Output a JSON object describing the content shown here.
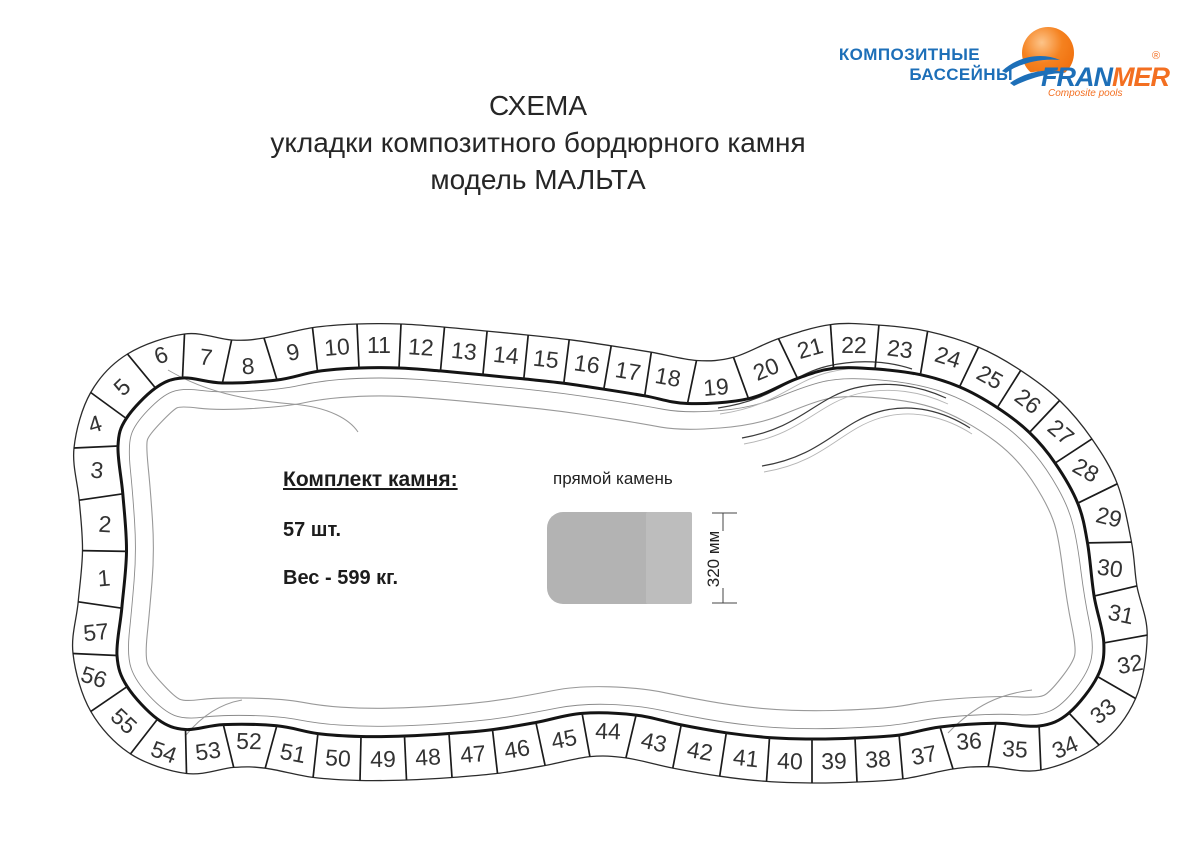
{
  "page": {
    "background": "#ffffff"
  },
  "brand": {
    "tagline_line1": "КОМПОЗИТНЫЕ",
    "tagline_line2": "БАССЕЙНЫ",
    "logo_fran": "FRAN",
    "logo_mer": "MER",
    "logo_subtitle": "Composite pools",
    "registered_mark": "®",
    "blue": "#1d6fb8",
    "orange": "#f36f21"
  },
  "title": {
    "line1": "СХЕМА",
    "line2": "укладки композитного бордюрного камня",
    "line3": "модель МАЛЬТА"
  },
  "kit": {
    "heading": "Комплект камня:",
    "quantity": "57 шт.",
    "weight": "Вес - 599 кг."
  },
  "stone_detail": {
    "label": "прямой камень",
    "dimension": "320 мм",
    "fill": "#b3b3b3",
    "end_fill": "#bdbdbd"
  },
  "diagram": {
    "stone_count": 57,
    "stones": [
      "1",
      "2",
      "3",
      "4",
      "5",
      "6",
      "7",
      "8",
      "9",
      "10",
      "11",
      "12",
      "13",
      "14",
      "15",
      "16",
      "17",
      "18",
      "19",
      "20",
      "21",
      "22",
      "23",
      "24",
      "25",
      "26",
      "27",
      "28",
      "29",
      "30",
      "31",
      "32",
      "33",
      "34",
      "35",
      "36",
      "37",
      "38",
      "39",
      "40",
      "41",
      "42",
      "43",
      "44",
      "45",
      "46",
      "47",
      "48",
      "49",
      "50",
      "51",
      "52",
      "53",
      "54",
      "55",
      "56",
      "57"
    ]
  }
}
